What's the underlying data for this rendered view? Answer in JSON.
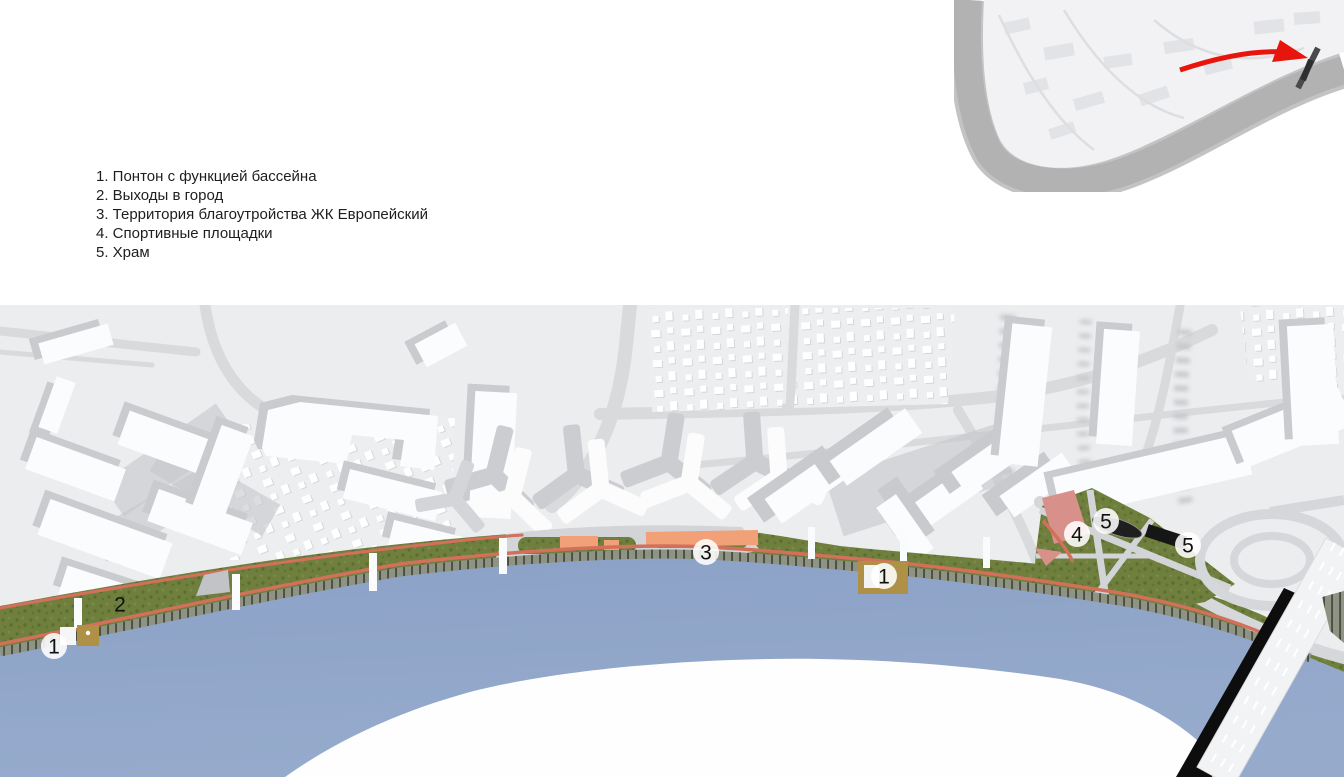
{
  "legend": {
    "items": [
      "1. Понтон с функцией бассейна",
      "2. Выходы в город",
      "3. Территория благоутройства ЖК Европейский",
      "4. Спортивные площадки",
      "5. Храм"
    ]
  },
  "inset_map": {
    "description": "city context map with highlighted embankment",
    "colors": {
      "highlight": "#E8150D",
      "river": "#B2B2B2",
      "land": "#F2F2F4"
    }
  },
  "site_plan": {
    "markers": [
      {
        "label": "1",
        "x": 54,
        "y": 646,
        "circle": true
      },
      {
        "label": "2",
        "x": 120,
        "y": 604,
        "circle": false
      },
      {
        "label": "3",
        "x": 706,
        "y": 552,
        "circle": true
      },
      {
        "label": "1",
        "x": 884,
        "y": 576,
        "circle": true
      },
      {
        "label": "4",
        "x": 1077,
        "y": 534,
        "circle": true
      },
      {
        "label": "5",
        "x": 1106,
        "y": 521,
        "circle": true
      },
      {
        "label": "5",
        "x": 1188,
        "y": 545,
        "circle": true
      }
    ],
    "colors": {
      "water": "#8CA3C7",
      "ground": "#ECEDEF",
      "greenery": "#6F7F3D",
      "promenade": "#D2705C",
      "sport_surface": "#F2A077",
      "pontoon": "#AE9147",
      "temple": "#1F1F1F",
      "park_plaza": "#D8908A"
    }
  }
}
